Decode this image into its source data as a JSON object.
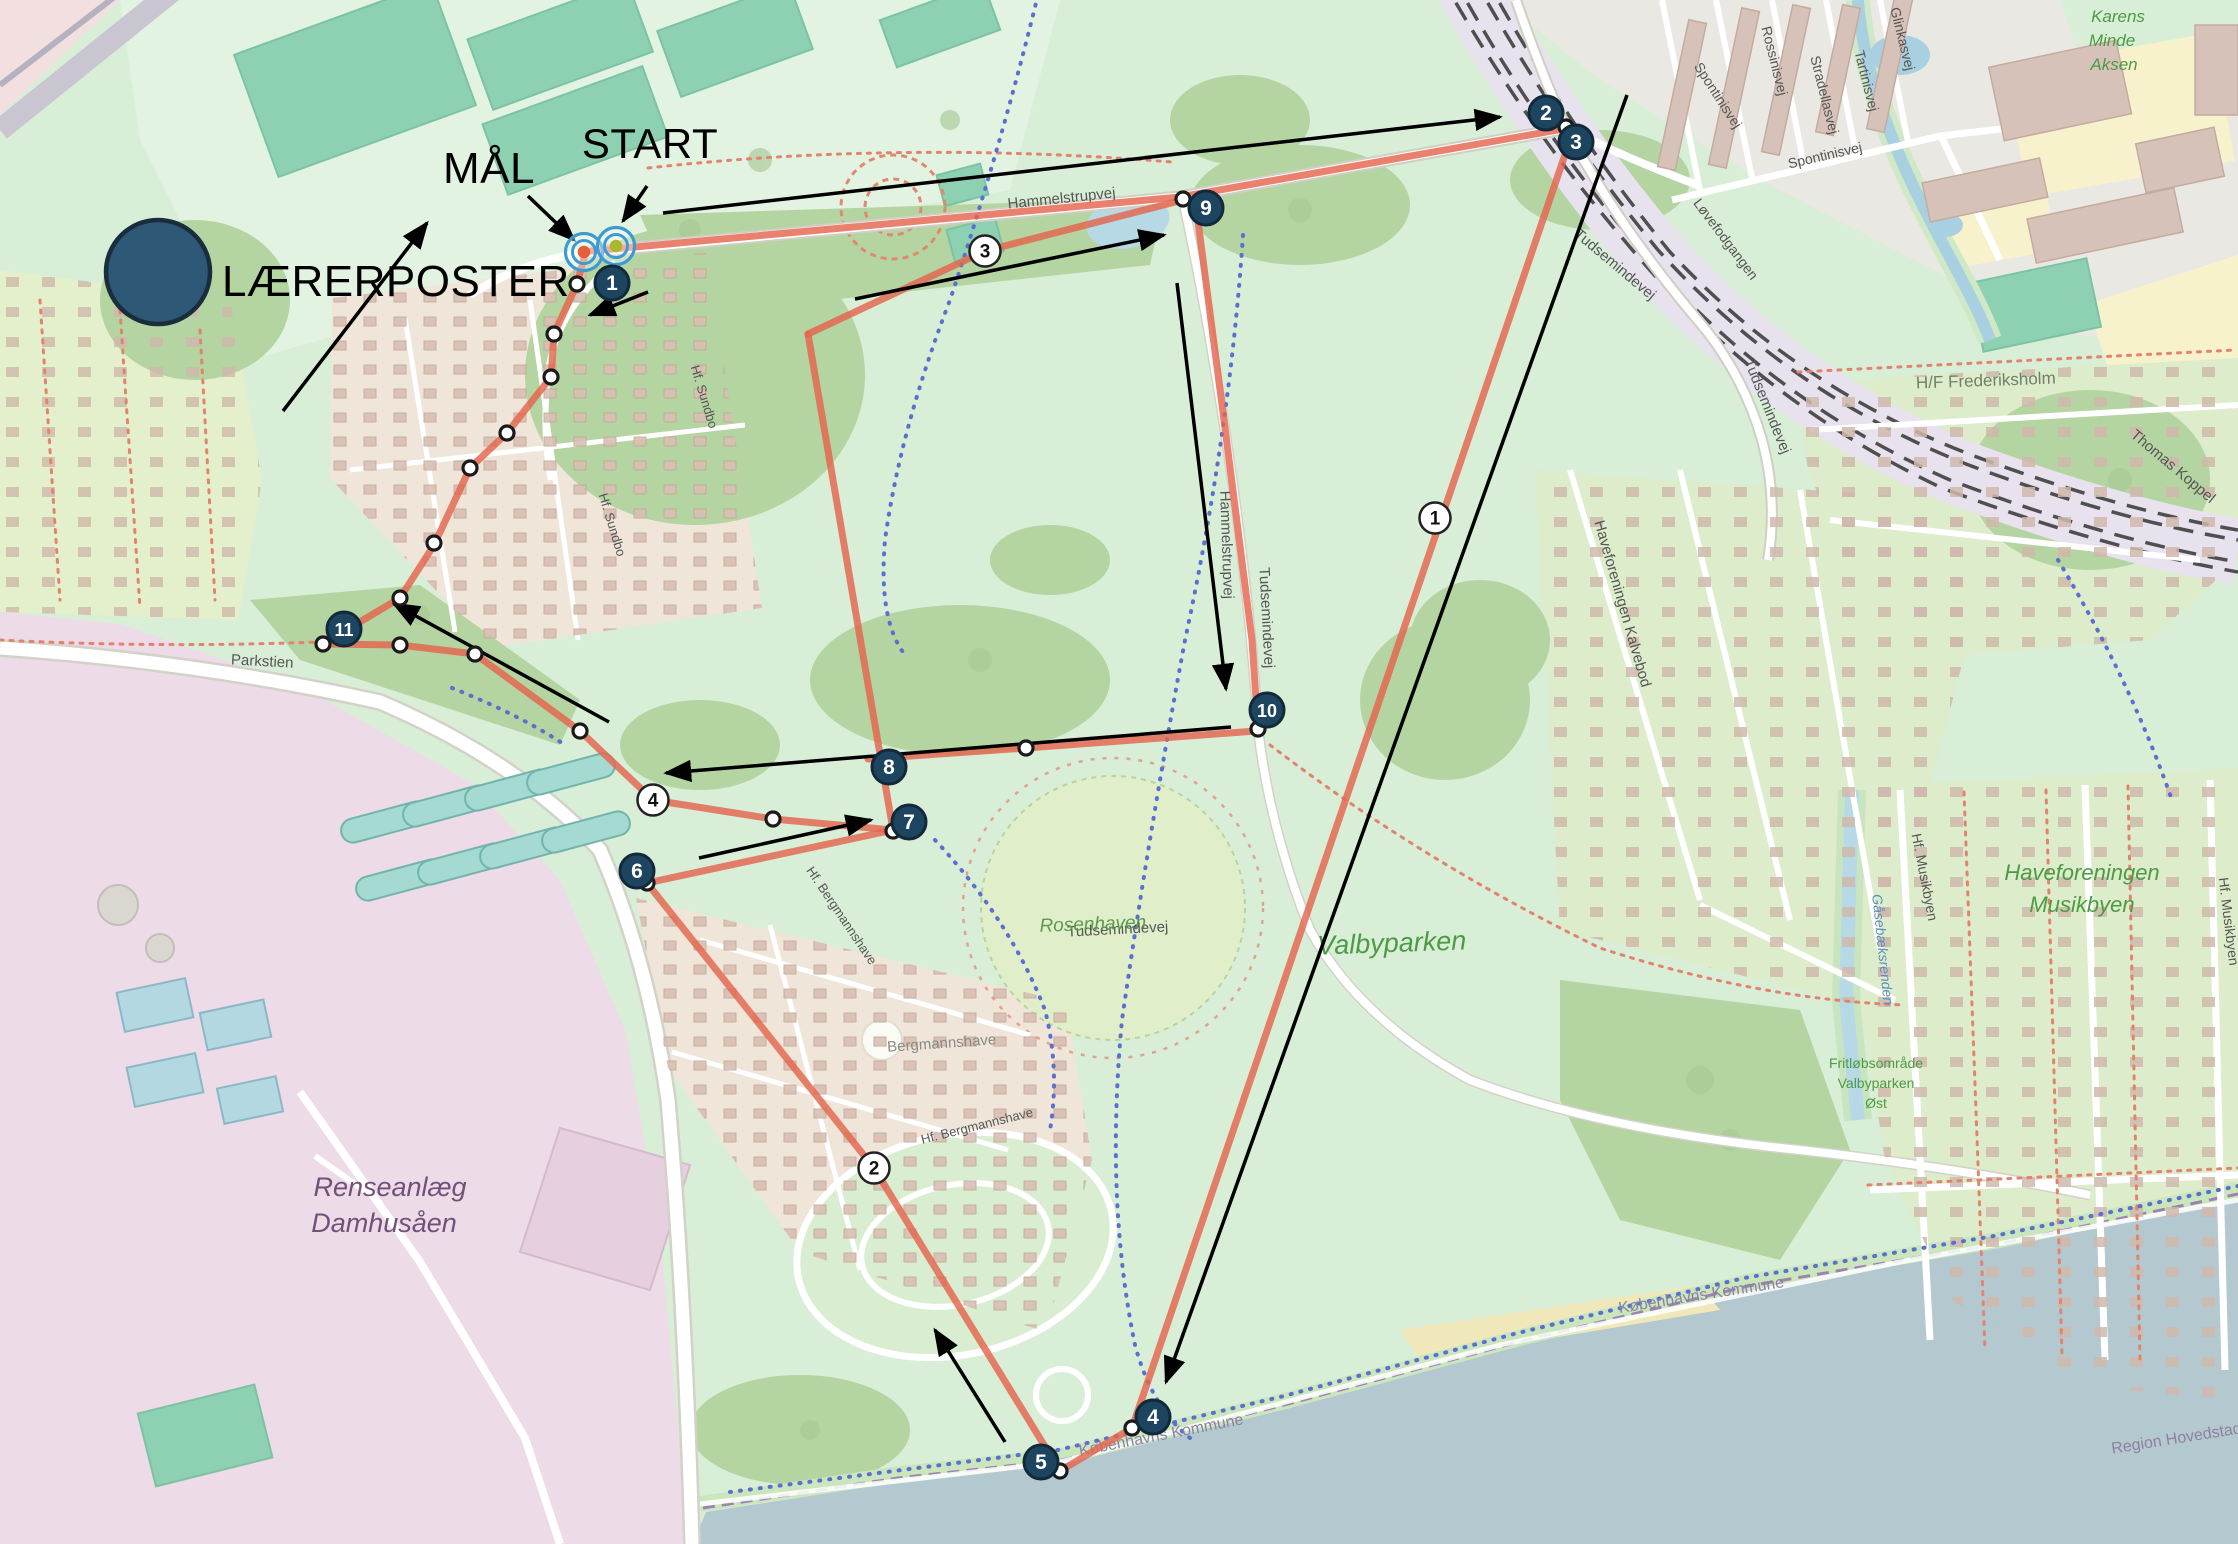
{
  "legend": {
    "post_label": "LÆRERPOSTER",
    "finish_label": "MÅL",
    "start_label": "START"
  },
  "colors": {
    "route_red": "#e4654e",
    "arrow_black": "#000000",
    "control_fill": "#1e4560",
    "control_border": "#12293a",
    "control_number": "#ffffff",
    "badge_fill": "#ffffff",
    "badge_border": "#222222",
    "badge_number": "#111111",
    "waypoint_fill": "#ffffff",
    "waypoint_border": "#1a1a1a",
    "ring_blue": "#3d9bd1",
    "finish_center": "#e2613a",
    "start_center": "#a9b92f",
    "legend_circle": "#2d5977",
    "legend_circle_border": "#192d3c",
    "water": "#b4c9cf"
  },
  "course": {
    "controls": [
      {
        "n": "1",
        "x": 612,
        "y": 283
      },
      {
        "n": "2",
        "x": 1546,
        "y": 113
      },
      {
        "n": "3",
        "x": 1576,
        "y": 142
      },
      {
        "n": "4",
        "x": 1153,
        "y": 1417
      },
      {
        "n": "5",
        "x": 1041,
        "y": 1462
      },
      {
        "n": "6",
        "x": 637,
        "y": 871
      },
      {
        "n": "7",
        "x": 909,
        "y": 822
      },
      {
        "n": "8",
        "x": 889,
        "y": 767
      },
      {
        "n": "9",
        "x": 1206,
        "y": 208
      },
      {
        "n": "10",
        "x": 1267,
        "y": 710
      },
      {
        "n": "11",
        "x": 344,
        "y": 629
      }
    ],
    "route_badges": [
      {
        "n": "1",
        "x": 1435,
        "y": 518
      },
      {
        "n": "2",
        "x": 874,
        "y": 1168
      },
      {
        "n": "3",
        "x": 985,
        "y": 251
      },
      {
        "n": "4",
        "x": 653,
        "y": 800
      }
    ],
    "waypoints": [
      [
        577,
        284
      ],
      [
        1566,
        127
      ],
      [
        1183,
        199
      ],
      [
        1258,
        729
      ],
      [
        1026,
        748
      ],
      [
        893,
        831
      ],
      [
        773,
        819
      ],
      [
        647,
        883
      ],
      [
        1132,
        1428
      ],
      [
        1060,
        1471
      ],
      [
        323,
        644
      ],
      [
        400,
        645
      ],
      [
        475,
        654
      ],
      [
        580,
        731
      ],
      [
        554,
        334
      ],
      [
        551,
        377
      ],
      [
        507,
        433
      ],
      [
        470,
        468
      ],
      [
        434,
        543
      ],
      [
        400,
        598
      ]
    ],
    "red_legs": [
      [
        [
          591,
          251
        ],
        [
          1180,
          197
        ],
        [
          1563,
          129
        ]
      ],
      [
        [
          1570,
          140
        ],
        [
          1132,
          1428
        ]
      ],
      [
        [
          1132,
          1428
        ],
        [
          1060,
          1471
        ]
      ],
      [
        [
          1060,
          1471
        ],
        [
          874,
          1168
        ],
        [
          647,
          883
        ]
      ],
      [
        [
          647,
          883
        ],
        [
          893,
          830
        ]
      ],
      [
        [
          893,
          830
        ],
        [
          808,
          334
        ]
      ],
      [
        [
          808,
          334
        ],
        [
          985,
          251
        ],
        [
          1183,
          200
        ]
      ],
      [
        [
          1196,
          206
        ],
        [
          1224,
          420
        ],
        [
          1252,
          640
        ],
        [
          1258,
          729
        ]
      ],
      [
        [
          868,
          759
        ],
        [
          1026,
          748
        ],
        [
          1256,
          731
        ]
      ],
      [
        [
          323,
          644
        ],
        [
          400,
          645
        ],
        [
          475,
          654
        ],
        [
          580,
          731
        ],
        [
          653,
          800
        ],
        [
          773,
          819
        ],
        [
          893,
          830
        ]
      ],
      [
        [
          323,
          644
        ],
        [
          400,
          598
        ],
        [
          434,
          545
        ],
        [
          470,
          468
        ],
        [
          507,
          433
        ],
        [
          551,
          377
        ],
        [
          554,
          334
        ],
        [
          577,
          284
        ],
        [
          584,
          258
        ]
      ]
    ],
    "arrows": [
      [
        663,
        213,
        1500,
        117
      ],
      [
        855,
        299,
        1164,
        235
      ],
      [
        1177,
        283,
        1226,
        689
      ],
      [
        1231,
        727,
        666,
        773
      ],
      [
        699,
        858,
        871,
        820
      ],
      [
        283,
        411,
        427,
        223
      ],
      [
        609,
        722,
        394,
        604
      ],
      [
        1627,
        95,
        1166,
        1382
      ],
      [
        1005,
        1442,
        935,
        1330
      ],
      [
        648,
        292,
        590,
        315
      ],
      [
        528,
        196,
        574,
        240
      ],
      [
        647,
        186,
        623,
        221
      ]
    ],
    "start_finish": {
      "finish": {
        "x": 584,
        "y": 252
      },
      "start": {
        "x": 616,
        "y": 246
      }
    },
    "legend_circle": {
      "x": 158,
      "y": 272,
      "r": 52
    }
  },
  "map_labels": [
    {
      "t": "Hammelstrupvej",
      "x": 1062,
      "y": 203,
      "r": -6,
      "s": 15,
      "c": "#555555"
    },
    {
      "t": "Hammelstrupvej",
      "x": 1222,
      "y": 545,
      "r": 88,
      "s": 15,
      "c": "#555555"
    },
    {
      "t": "Tudsemindevej",
      "x": 1612,
      "y": 268,
      "r": 40,
      "s": 15,
      "c": "#555555"
    },
    {
      "t": "Tudsemindevej",
      "x": 1763,
      "y": 408,
      "r": 68,
      "s": 15,
      "c": "#555555"
    },
    {
      "t": "Tudsemindevej",
      "x": 1262,
      "y": 618,
      "r": 87,
      "s": 15,
      "c": "#555555"
    },
    {
      "t": "Tudsemindevej",
      "x": 1118,
      "y": 934,
      "r": -3,
      "s": 15,
      "c": "#555555"
    },
    {
      "t": "Parkstien",
      "x": 262,
      "y": 666,
      "r": 3,
      "s": 15,
      "c": "#555555"
    },
    {
      "t": "Spontinisvej",
      "x": 1714,
      "y": 98,
      "r": 57,
      "s": 14,
      "c": "#555555"
    },
    {
      "t": "Spontinisvej",
      "x": 1826,
      "y": 160,
      "r": -13,
      "s": 14,
      "c": "#555555"
    },
    {
      "t": "Rossinisvej",
      "x": 1770,
      "y": 62,
      "r": 76,
      "s": 14,
      "c": "#555555"
    },
    {
      "t": "Stradellasvej",
      "x": 1820,
      "y": 96,
      "r": 76,
      "s": 14,
      "c": "#555555"
    },
    {
      "t": "Tartinisvej",
      "x": 1862,
      "y": 82,
      "r": 76,
      "s": 14,
      "c": "#555555"
    },
    {
      "t": "Glinkasvej",
      "x": 1898,
      "y": 40,
      "r": 76,
      "s": 14,
      "c": "#555555"
    },
    {
      "t": "Løvefodgangen",
      "x": 1722,
      "y": 242,
      "r": 53,
      "s": 14,
      "c": "#555555"
    },
    {
      "t": "Karens",
      "x": 2118,
      "y": 22,
      "r": 0,
      "s": 17,
      "c": "#4d9a44",
      "i": 1
    },
    {
      "t": "Minde",
      "x": 2112,
      "y": 46,
      "r": 0,
      "s": 17,
      "c": "#4d9a44",
      "i": 1
    },
    {
      "t": "Aksen",
      "x": 2114,
      "y": 70,
      "r": 0,
      "s": 17,
      "c": "#4d9a44",
      "i": 1
    },
    {
      "t": "H/F Frederiksholm",
      "x": 1986,
      "y": 386,
      "r": -2,
      "s": 17,
      "c": "#6f8066"
    },
    {
      "t": "Thomas Koppel",
      "x": 2170,
      "y": 470,
      "r": 40,
      "s": 15,
      "c": "#555555"
    },
    {
      "t": "Haveforeningen Kalvebod",
      "x": 1618,
      "y": 605,
      "r": 74,
      "s": 15,
      "c": "#555555"
    },
    {
      "t": "Haveforeningen",
      "x": 2082,
      "y": 880,
      "r": 0,
      "s": 22,
      "c": "#4d9a44",
      "i": 1
    },
    {
      "t": "Musikbyen",
      "x": 2082,
      "y": 912,
      "r": 0,
      "s": 22,
      "c": "#4d9a44",
      "i": 1
    },
    {
      "t": "Hf. Musikbyen",
      "x": 1920,
      "y": 878,
      "r": 79,
      "s": 14,
      "c": "#555555"
    },
    {
      "t": "Hf. Musikbyen",
      "x": 2224,
      "y": 922,
      "r": 83,
      "s": 14,
      "c": "#555555"
    },
    {
      "t": "Gåsebæksrenden",
      "x": 1878,
      "y": 950,
      "r": 84,
      "s": 14,
      "c": "#5a8fc0",
      "i": 1
    },
    {
      "t": "Fritløbsområde",
      "x": 1876,
      "y": 1068,
      "r": 0,
      "s": 14,
      "c": "#4d9a44"
    },
    {
      "t": "Valbyparken",
      "x": 1876,
      "y": 1088,
      "r": 0,
      "s": 14,
      "c": "#4d9a44"
    },
    {
      "t": "Øst",
      "x": 1876,
      "y": 1108,
      "r": 0,
      "s": 14,
      "c": "#4d9a44"
    },
    {
      "t": "Rosenhaven",
      "x": 1093,
      "y": 930,
      "r": -2,
      "s": 19,
      "c": "#5a9a50",
      "i": 1
    },
    {
      "t": "Valbyparken",
      "x": 1392,
      "y": 952,
      "r": -2,
      "s": 27,
      "c": "#4d9a44",
      "i": 1
    },
    {
      "t": "Renseanlæg",
      "x": 390,
      "y": 1196,
      "r": 0,
      "s": 27,
      "c": "#70517a",
      "i": 1
    },
    {
      "t": "Damhusåen",
      "x": 384,
      "y": 1232,
      "r": 0,
      "s": 27,
      "c": "#70517a",
      "i": 1
    },
    {
      "t": "Hf. Sundbo",
      "x": 700,
      "y": 398,
      "r": 73,
      "s": 13,
      "c": "#555555"
    },
    {
      "t": "Hf. Sundbo",
      "x": 608,
      "y": 526,
      "r": 73,
      "s": 13,
      "c": "#555555"
    },
    {
      "t": "Hf. Bergmannshave",
      "x": 838,
      "y": 918,
      "r": 56,
      "s": 13,
      "c": "#555555"
    },
    {
      "t": "Bergmannshave",
      "x": 942,
      "y": 1048,
      "r": -4,
      "s": 15,
      "c": "#8a8a84"
    },
    {
      "t": "Hf. Bergmannshave",
      "x": 978,
      "y": 1130,
      "r": -14,
      "s": 13,
      "c": "#555555"
    },
    {
      "t": "Københavns Kommune",
      "x": 1162,
      "y": 1440,
      "r": -11,
      "s": 16,
      "c": "#8d81a2"
    },
    {
      "t": "Københavns Kommune",
      "x": 1702,
      "y": 1300,
      "r": -9,
      "s": 16,
      "c": "#8d81a2"
    },
    {
      "t": "Region Hovedstaden",
      "x": 2186,
      "y": 1442,
      "r": -9,
      "s": 16,
      "c": "#8d81a2"
    }
  ]
}
